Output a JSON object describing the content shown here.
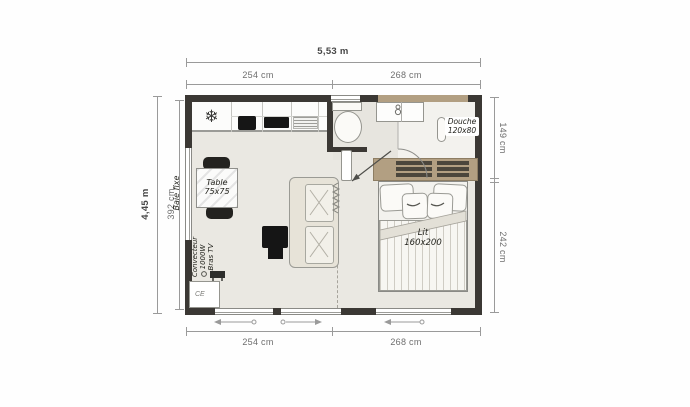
{
  "plan": {
    "dimensions": {
      "top_total": "5,53 m",
      "top_seg1": "254 cm",
      "top_seg2": "268 cm",
      "left_total": "4,45 m",
      "left_inner": "392 cm",
      "right_seg1": "149 cm",
      "right_seg2": "242 cm",
      "bottom_seg1": "254 cm",
      "bottom_seg2": "268 cm"
    },
    "labels": {
      "left_window": "Baie fixe",
      "table_name": "Table",
      "table_size": "75x75",
      "shower_name": "Douche",
      "shower_size": "120x80",
      "bed_name": "Lit",
      "bed_size": "160x200",
      "heater_line1": "Convecteur",
      "heater_line2": "1000W",
      "heater_line3": "Bras TV",
      "ce_mark": "CE"
    },
    "icons": {
      "fridge_snowflake": "❄"
    },
    "colors": {
      "wall": "#3b3834",
      "floor": "#eae8e2",
      "wood": "#b29f82",
      "wood_dark": "#4b463c",
      "dim_line": "#9a9a9a",
      "dim_text": "#6e6e6e"
    }
  }
}
